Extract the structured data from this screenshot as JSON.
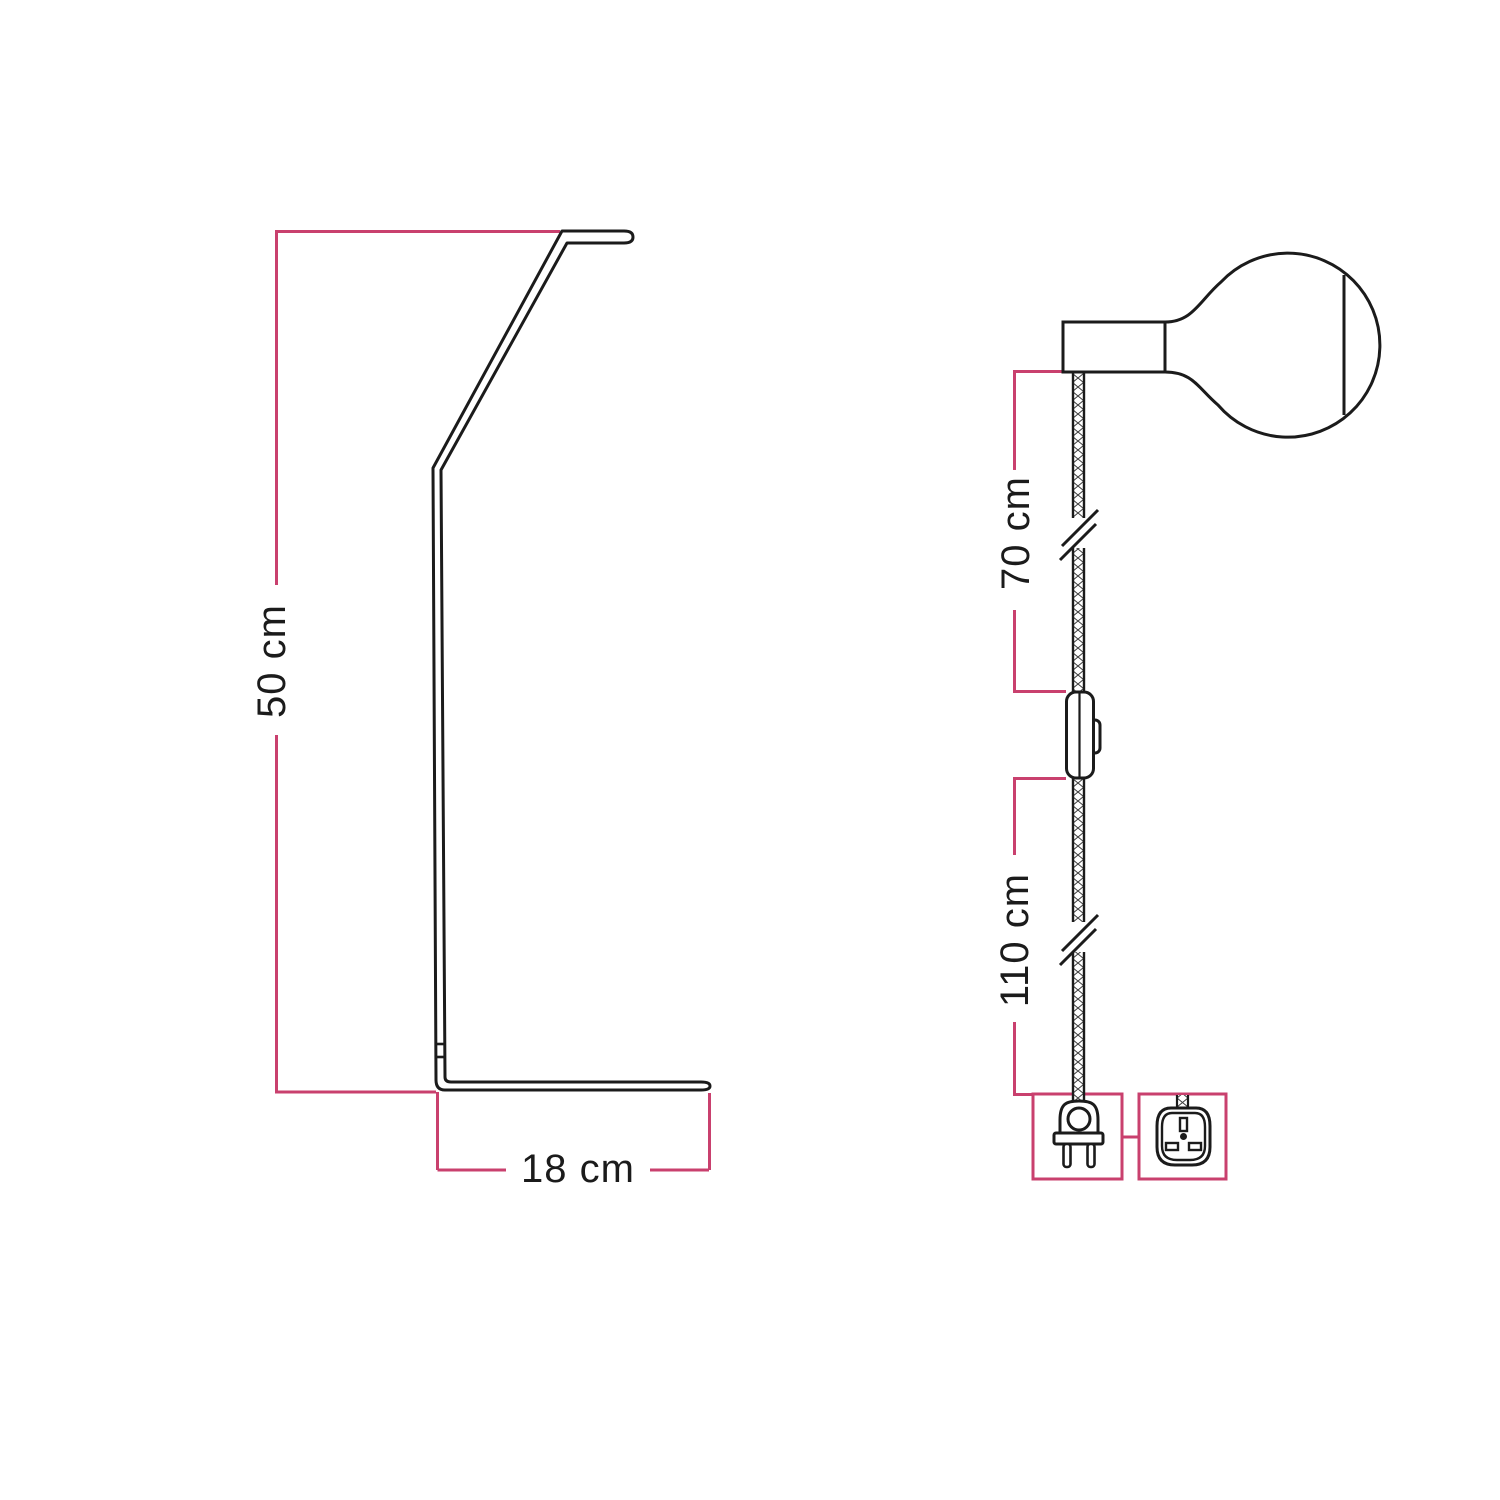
{
  "colors": {
    "background": "#ffffff",
    "outline": "#1b1b1b",
    "dimension_line": "#c9406e"
  },
  "left_figure": {
    "name": "table lamp stand side profile",
    "height_label": "50 cm",
    "base_depth_label": "18 cm"
  },
  "right_figure": {
    "name": "power cord with lamp holder, globe bulb, inline switch and plug",
    "upper_cable_label": "70 cm",
    "lower_cable_label": "110 cm",
    "icons": {
      "bulb": "globe-bulb-icon",
      "holder": "lamp-holder-icon",
      "cable": "braided-cable",
      "break": "cable-break-icon",
      "switch": "inline-switch-icon",
      "euro_plug": "euro-plug-icon",
      "uk_plug": "uk-plug-icon"
    }
  }
}
